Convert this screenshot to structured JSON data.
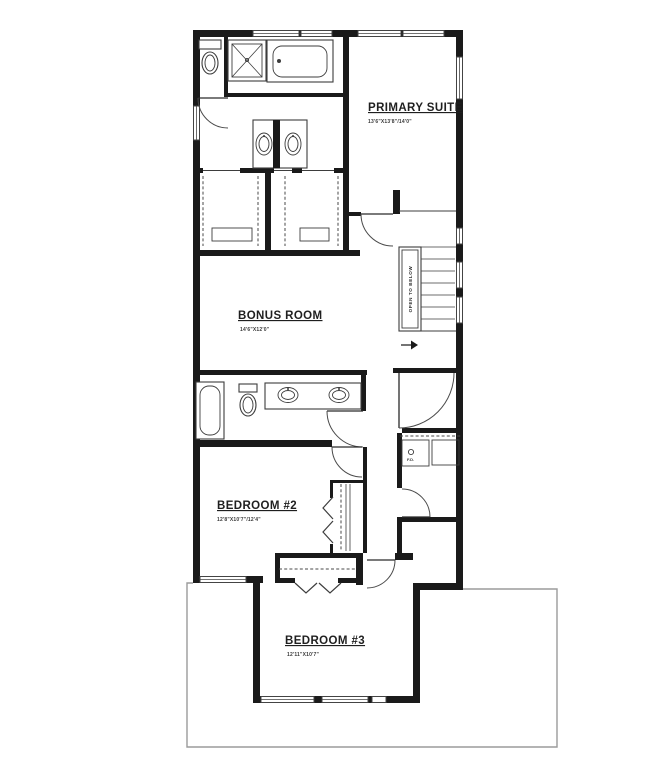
{
  "plan": {
    "rooms": [
      {
        "name": "PRIMARY SUITE",
        "dims": "13'6\"X13'8\"/14'0\""
      },
      {
        "name": "BONUS ROOM",
        "dims": "14'6\"X12'0\""
      },
      {
        "name": "BEDROOM #2",
        "dims": "12'8\"X10'7\"/12'4\""
      },
      {
        "name": "BEDROOM #3",
        "dims": "12'11\"X10'7\""
      }
    ],
    "stair_note": "OPEN TO BELOW",
    "laundry_note": "F.D.",
    "colors": {
      "wall": "#1a1a1a",
      "line": "#3d3d3d",
      "roofline": "#9b9b9b",
      "background": "#ffffff"
    }
  }
}
